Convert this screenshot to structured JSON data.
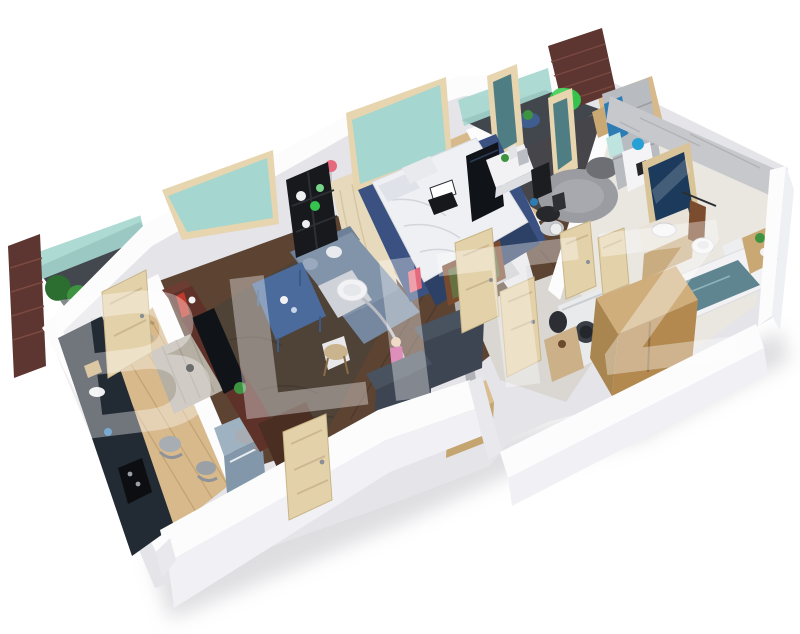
{
  "watermark": {
    "text": "BLITZ",
    "color": "#ffffff"
  },
  "palette": {
    "wall_top": "#fcfcfd",
    "wall_face": "#f1f1f5",
    "wall_inner": "#e8e8ed",
    "slab": "#e4e4e9",
    "shadow": "#c4c4ca",
    "glass_teal": "#a5d6cf",
    "frame_wood": "#e6d5ae",
    "door_wood": "#e3d2a9",
    "brick": "#5d3531",
    "brick_line": "#7b4a40",
    "plant_green": "#3e9340",
    "plant_dark": "#2c6e2f",
    "floor_oak": "#d7b98b",
    "floor_oak_line": "#c2a271",
    "floor_walnut": "#5c4332",
    "carpet_brown": "#4f4237",
    "rug_navy": "#3a5181",
    "bed_white": "#eef0f3",
    "pillow_gray": "#dfe2e8",
    "bedframe_navy": "#2c4165",
    "headboard_cream": "#e7dabc",
    "kitchen_unit": "#222a33",
    "fridge_steel": "#9fb2c2",
    "table_graywood": "#b6b0a4",
    "chair_gray": "#a7adb3",
    "chair_wood": "#b3946a",
    "media_maroon": "#5e3129",
    "tv_black": "#101317",
    "sofa_blue": "#8294aa",
    "sofa_blue_dark": "#6e8097",
    "coffee_table_blue": "#4a6b9b",
    "lamp_white": "#f3f3f5",
    "metal_gray": "#b9bcc2",
    "stool_wood": "#c9b48e",
    "doll_pink": "#cb4f95",
    "navy_unit": "#49525f",
    "navy_unit_dark": "#3d4552",
    "wood_unit": "#cfae7c",
    "wood_unit_dark": "#b3894f",
    "marble": "#c6c8cc",
    "marble_dark": "#b0b2b7",
    "bath_floor": "#eae7e1",
    "mirror_navy": "#1c3a5c",
    "porcelain": "#f6f6f8",
    "tub_water": "#5f8591",
    "towel_brown": "#7c4c2e",
    "office_floor": "#45454a",
    "rug_gray": "#9b9ca1",
    "wardrobe_gray": "#b8bbbf",
    "clothes_blue": "#2d7cb4",
    "lamp_blue": "#27a0d6",
    "accent_green": "#35c24d",
    "accent_pink": "#e56b7c",
    "accent_red": "#c03a2e"
  }
}
